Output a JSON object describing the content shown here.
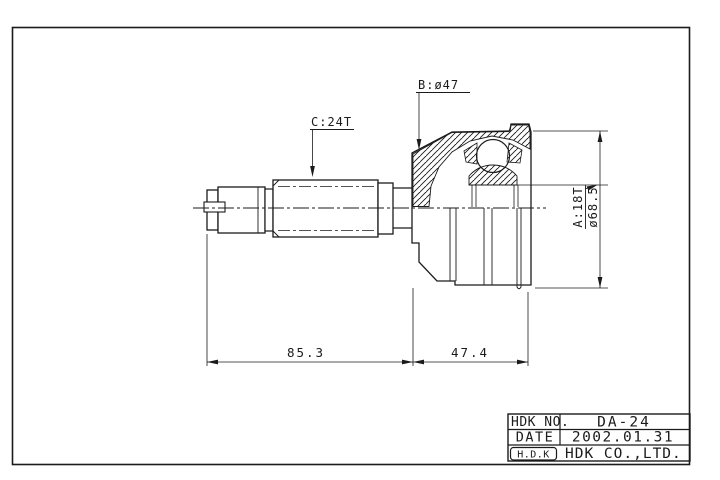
{
  "colors": {
    "line": "#1b1b1b",
    "background": "#ffffff"
  },
  "drawing": {
    "callouts": {
      "b": "B:ø47",
      "c": "C:24T",
      "a": "A:18T",
      "a_diameter": "ø68.5"
    },
    "dimensions": {
      "shaft_length": "85.3",
      "joint_length": "47.4"
    }
  },
  "title_block": {
    "rows": [
      {
        "label": "HDK NO.",
        "value": "DA-24"
      },
      {
        "label": "DATE",
        "value": "2002.01.31"
      },
      {
        "label": "H.D.K",
        "value": "HDK CO.,LTD."
      }
    ]
  }
}
